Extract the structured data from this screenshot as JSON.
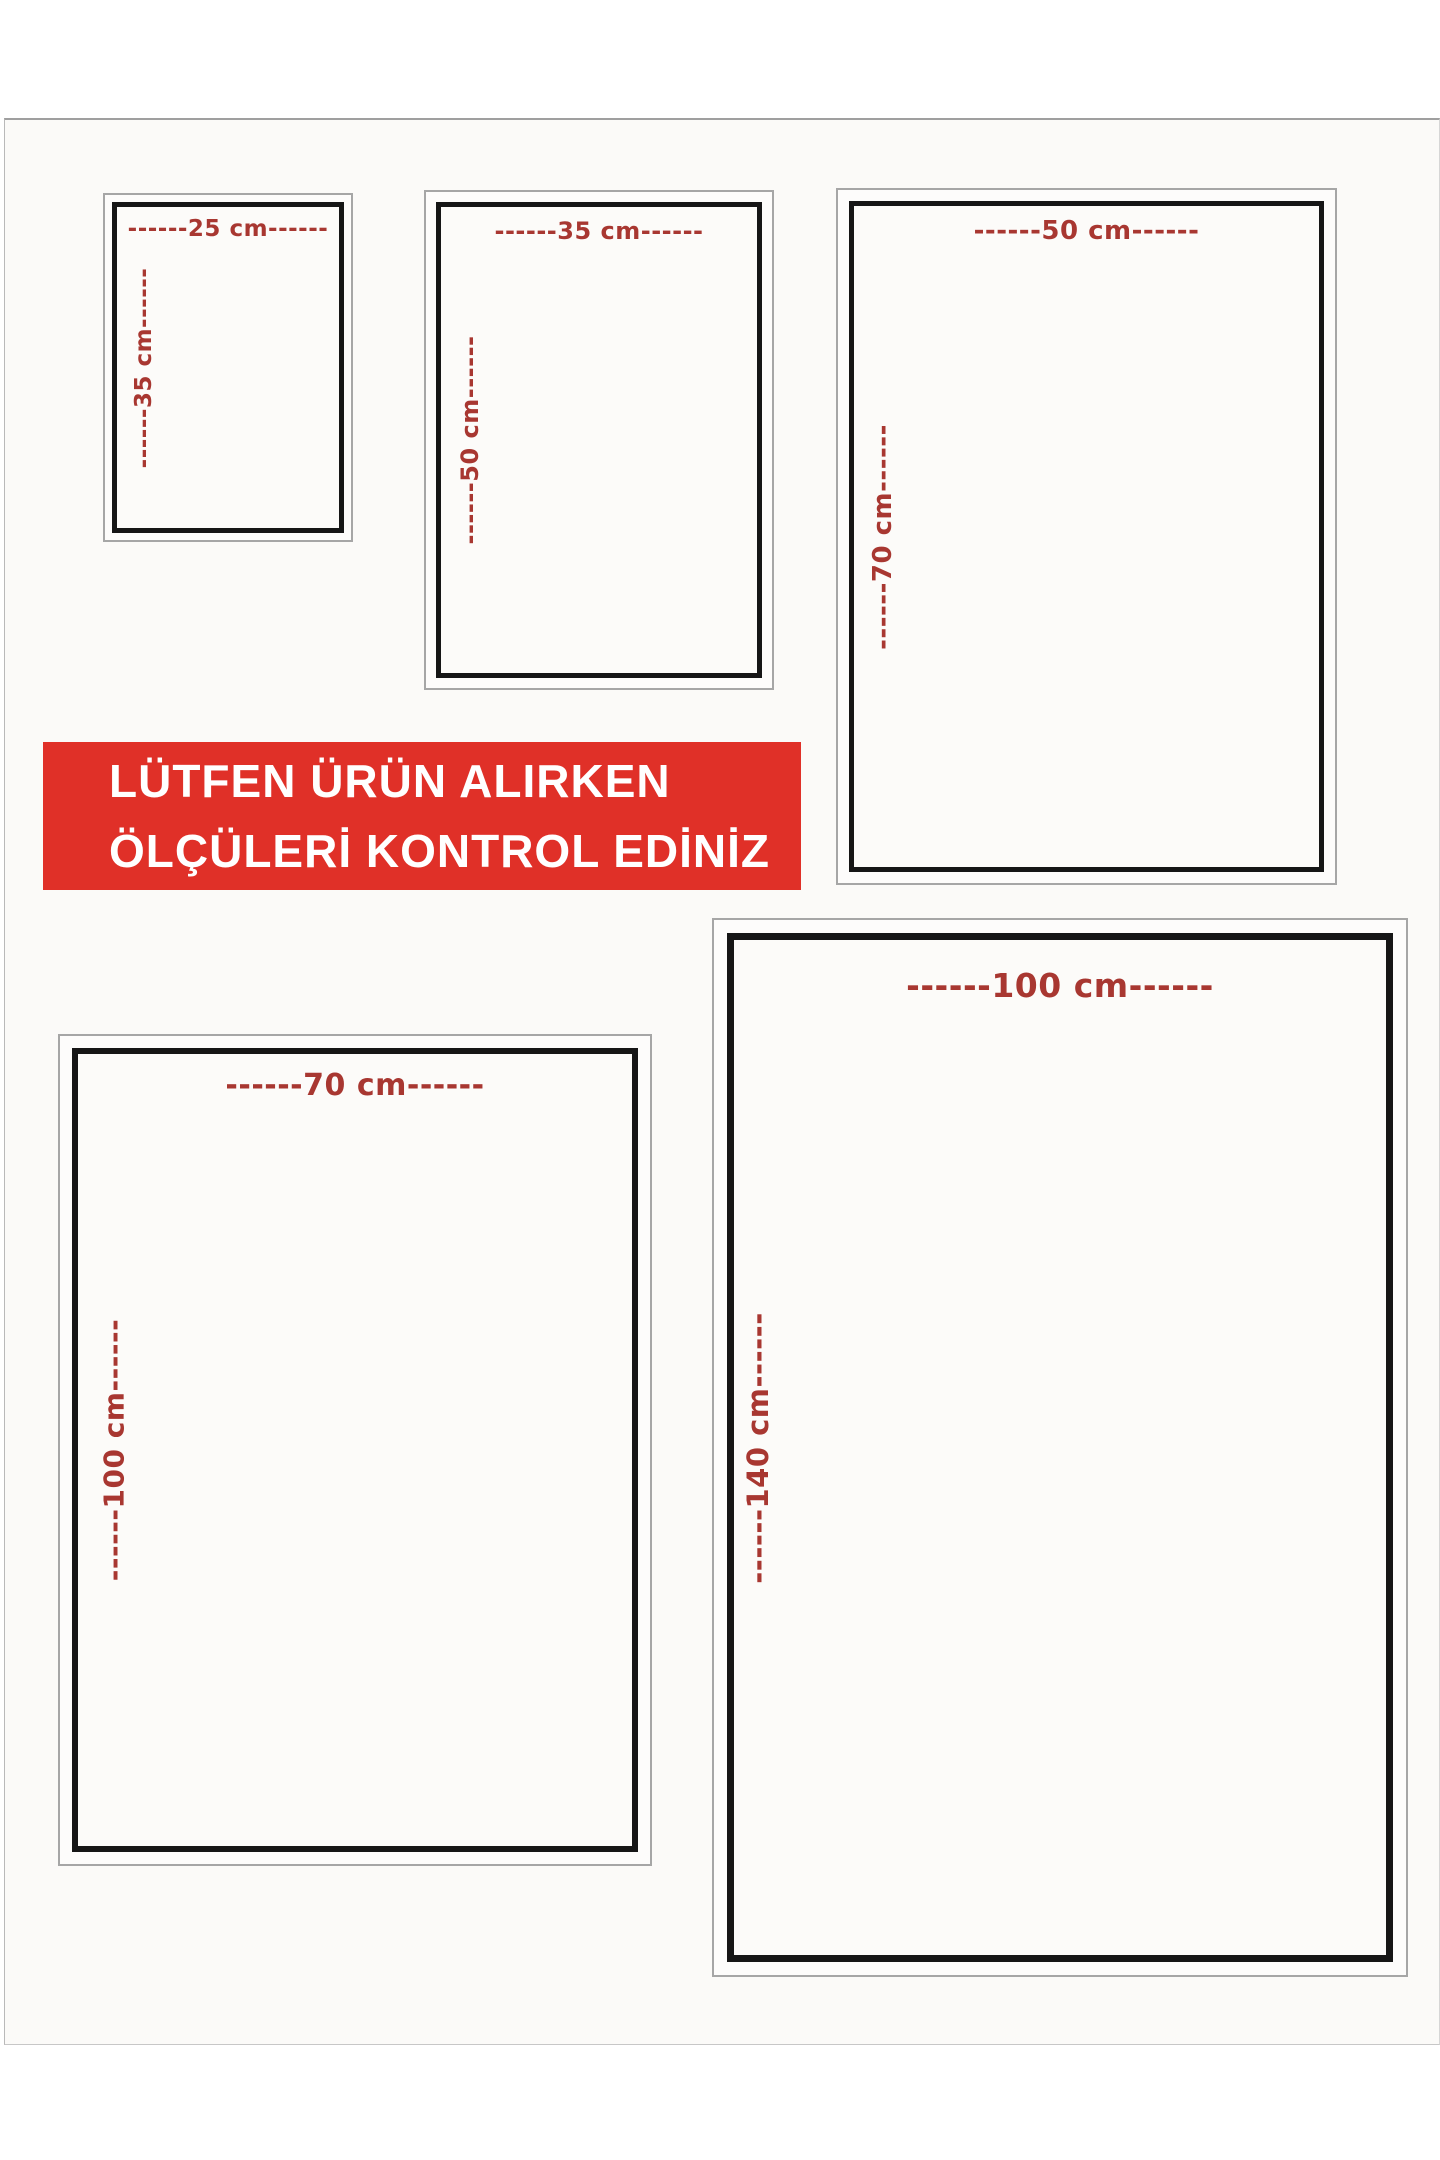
{
  "banner": {
    "line1": "LÜTFEN ÜRÜN ALIRKEN",
    "line2": "ÖLÇÜLERİ KONTROL EDİNİZ"
  },
  "sizes": [
    {
      "width_cm": "25 cm",
      "height_cm": "35 cm",
      "width_label": "------25 cm------",
      "height_label": "------35 cm------"
    },
    {
      "width_cm": "35 cm",
      "height_cm": "50 cm",
      "width_label": "------35 cm------",
      "height_label": "------50 cm------"
    },
    {
      "width_cm": "50 cm",
      "height_cm": "70 cm",
      "width_label": "------50 cm------",
      "height_label": "------70 cm------"
    },
    {
      "width_cm": "70 cm",
      "height_cm": "100 cm",
      "width_label": "------70 cm------",
      "height_label": "------100 cm------"
    },
    {
      "width_cm": "100 cm",
      "height_cm": "140 cm",
      "width_label": "------100 cm------",
      "height_label": "------140 cm------"
    }
  ],
  "colors": {
    "banner_bg": "#e03028",
    "banner_text": "#ffffff",
    "label_red": "#a83731",
    "frame_black": "#161616",
    "frame_gray": "#a6a6a6"
  }
}
